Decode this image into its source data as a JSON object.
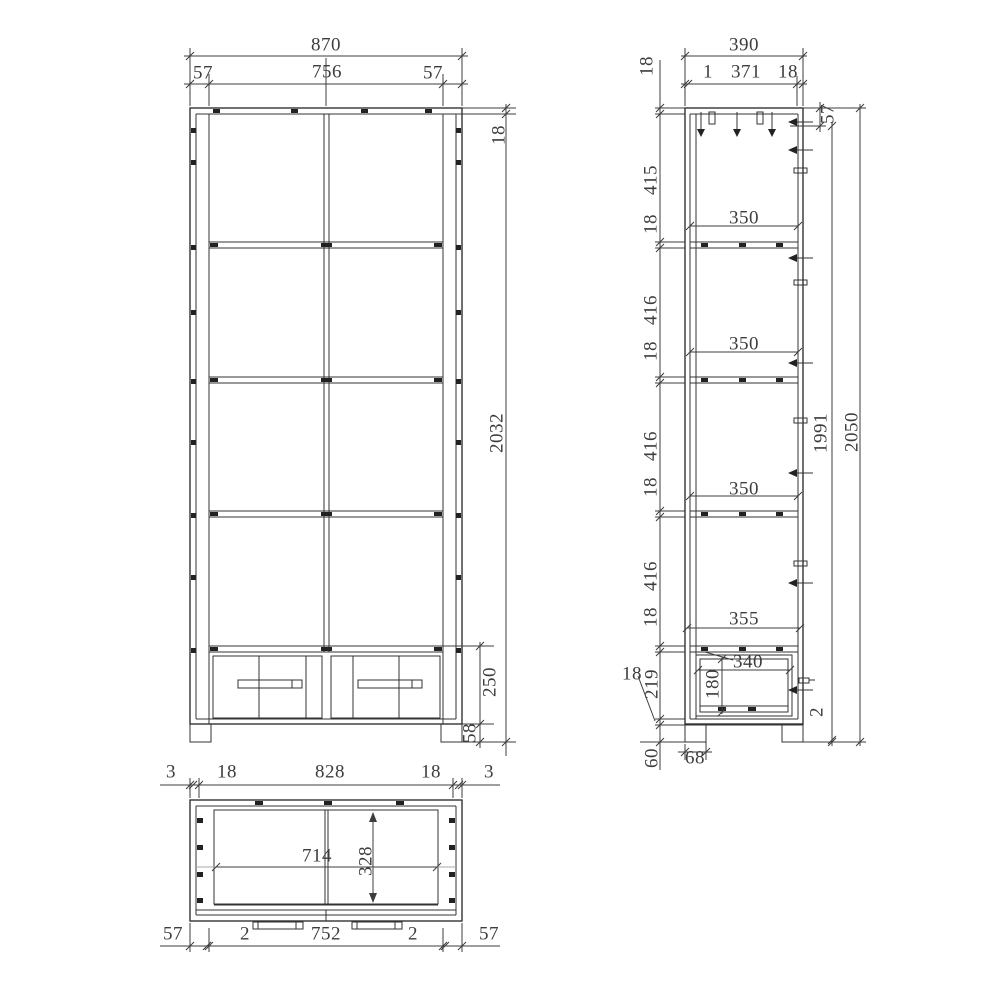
{
  "meta": {
    "drawing_type": "cabinet-three-view-technical-drawing",
    "background_color": "#ffffff",
    "line_color": "#333333",
    "text_color": "#3d3d3d"
  },
  "views": {
    "front": {
      "name": "front-view",
      "labels": [
        {
          "t": "870",
          "x": 326,
          "y": 45
        },
        {
          "t": "57",
          "x": 203,
          "y": 73
        },
        {
          "t": "756",
          "x": 327,
          "y": 72
        },
        {
          "t": "57",
          "x": 433,
          "y": 73
        },
        {
          "t": "18",
          "x": 499,
          "y": 135,
          "r": 1
        },
        {
          "t": "2032",
          "x": 497,
          "y": 433,
          "r": 1
        },
        {
          "t": "250",
          "x": 490,
          "y": 682,
          "r": 1
        },
        {
          "t": "58",
          "x": 470,
          "y": 733,
          "r": 1
        }
      ]
    },
    "side": {
      "name": "side-view",
      "labels": [
        {
          "t": "390",
          "x": 744,
          "y": 45
        },
        {
          "t": "1",
          "x": 708,
          "y": 72
        },
        {
          "t": "371",
          "x": 746,
          "y": 72
        },
        {
          "t": "18",
          "x": 788,
          "y": 72
        },
        {
          "t": "18",
          "x": 647,
          "y": 66,
          "r": 1
        },
        {
          "t": "415",
          "x": 651,
          "y": 180,
          "r": 1
        },
        {
          "t": "18",
          "x": 651,
          "y": 224,
          "r": 1
        },
        {
          "t": "350",
          "x": 744,
          "y": 218
        },
        {
          "t": "416",
          "x": 651,
          "y": 310,
          "r": 1
        },
        {
          "t": "18",
          "x": 651,
          "y": 351,
          "r": 1
        },
        {
          "t": "350",
          "x": 744,
          "y": 344
        },
        {
          "t": "416",
          "x": 651,
          "y": 446,
          "r": 1
        },
        {
          "t": "18",
          "x": 651,
          "y": 487,
          "r": 1
        },
        {
          "t": "350",
          "x": 744,
          "y": 489
        },
        {
          "t": "416",
          "x": 651,
          "y": 576,
          "r": 1
        },
        {
          "t": "18",
          "x": 651,
          "y": 617,
          "r": 1
        },
        {
          "t": "355",
          "x": 744,
          "y": 619
        },
        {
          "t": "340",
          "x": 748,
          "y": 662
        },
        {
          "t": "180",
          "x": 713,
          "y": 684,
          "r": 1
        },
        {
          "t": "219",
          "x": 652,
          "y": 684,
          "r": 1
        },
        {
          "t": "18",
          "x": 632,
          "y": 674
        },
        {
          "t": "68",
          "x": 695,
          "y": 758
        },
        {
          "t": "60",
          "x": 652,
          "y": 758,
          "r": 1
        },
        {
          "t": "57",
          "x": 828,
          "y": 114,
          "r": 1
        },
        {
          "t": "1991",
          "x": 821,
          "y": 433,
          "r": 1
        },
        {
          "t": "2050",
          "x": 852,
          "y": 432,
          "r": 1
        },
        {
          "t": "2",
          "x": 817,
          "y": 712,
          "r": 1
        }
      ]
    },
    "plan": {
      "name": "plan-view",
      "labels": [
        {
          "t": "3",
          "x": 171,
          "y": 772
        },
        {
          "t": "18",
          "x": 227,
          "y": 772
        },
        {
          "t": "828",
          "x": 330,
          "y": 772
        },
        {
          "t": "18",
          "x": 431,
          "y": 772
        },
        {
          "t": "3",
          "x": 489,
          "y": 772
        },
        {
          "t": "714",
          "x": 317,
          "y": 856
        },
        {
          "t": "328",
          "x": 366,
          "y": 861,
          "r": 1
        },
        {
          "t": "57",
          "x": 173,
          "y": 934
        },
        {
          "t": "2",
          "x": 245,
          "y": 934
        },
        {
          "t": "752",
          "x": 326,
          "y": 934
        },
        {
          "t": "2",
          "x": 413,
          "y": 934
        },
        {
          "t": "57",
          "x": 489,
          "y": 934
        }
      ]
    }
  }
}
